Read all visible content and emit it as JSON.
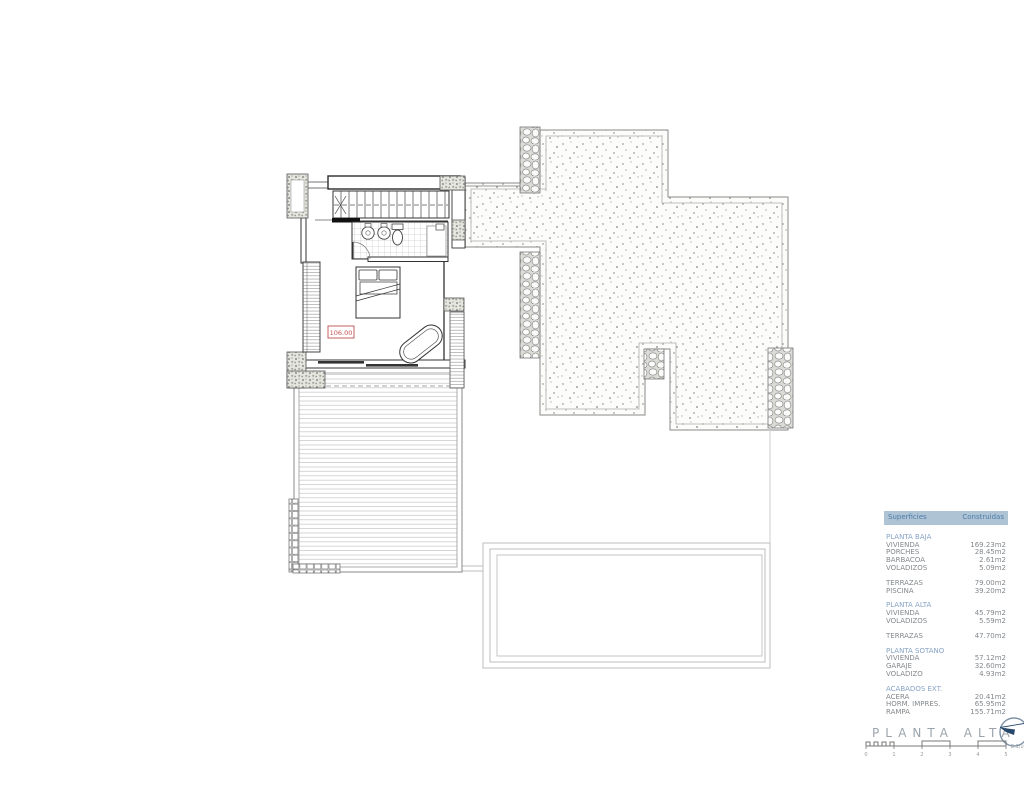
{
  "plan": {
    "level_label": "106.00",
    "drawing_elements": [
      "staircase",
      "bathroom",
      "double-bed",
      "bathtub",
      "wardrobe",
      "wood-deck-terrace",
      "gravel-roof-terrace",
      "stone-walls",
      "swimming-pool"
    ]
  },
  "surfaces_table": {
    "header": {
      "col1": "Superficies",
      "col2": "Construidas"
    },
    "sections": [
      {
        "name": "PLANTA BAJA",
        "rows": [
          [
            "VIVIENDA",
            "169.23m2"
          ],
          [
            "PORCHES",
            "28.45m2"
          ],
          [
            "BARBACOA",
            "2.61m2"
          ],
          [
            "VOLADIZOS",
            "5.09m2"
          ]
        ]
      },
      {
        "name": "",
        "rows": [
          [
            "TERRAZAS",
            "79.00m2"
          ],
          [
            "PISCINA",
            "39.20m2"
          ]
        ]
      },
      {
        "name": "PLANTA ALTA",
        "rows": [
          [
            "VIVIENDA",
            "45.79m2"
          ],
          [
            "VOLADIZOS",
            "5.59m2"
          ]
        ]
      },
      {
        "name": "",
        "rows": [
          [
            "TERRAZAS",
            "47.70m2"
          ]
        ]
      },
      {
        "name": "PLANTA SOTANO",
        "rows": [
          [
            "VIVIENDA",
            "57.12m2"
          ],
          [
            "GARAJE",
            "32.60m2"
          ],
          [
            "VOLADIZO",
            "4.93m2"
          ]
        ]
      },
      {
        "name": "ACABADOS EXT.",
        "rows": [
          [
            "ACERA",
            "20.41m2"
          ],
          [
            "HORM. IMPRES.",
            "65.95m2"
          ],
          [
            "RAMPA",
            "155.71m2"
          ]
        ]
      }
    ]
  },
  "title_block": {
    "title": "PLANTA ALTA",
    "scale_label": "E:1/100",
    "scale_numbers": [
      "0",
      "1",
      "2",
      "3",
      "4",
      "5"
    ]
  },
  "colors": {
    "table_header_bg": "#aec3d4",
    "table_header_text": "#4e7dab",
    "section_text": "#86a3c6",
    "body_text": "#84888c",
    "level_label_red": "#c0504d",
    "logo_navy": "#28486b",
    "title_gray": "#9ba4ac"
  }
}
